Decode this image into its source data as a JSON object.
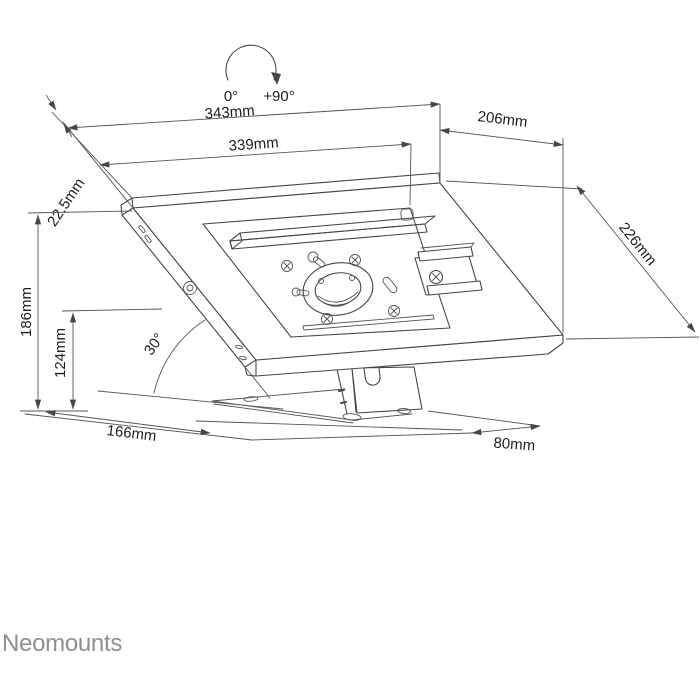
{
  "brand": "Neomounts",
  "colors": {
    "line": "#474747",
    "label": "#1e1e1e",
    "brand_gray": "#8f8f8f",
    "background": "#ffffff"
  },
  "rotation_indicator": {
    "start": "0°",
    "end": "+90°"
  },
  "dimensions": {
    "outer_width": "343mm",
    "inner_width": "339mm",
    "top_depth": "206mm",
    "side_depth": "226mm",
    "edge_thickness": "22.5mm",
    "total_height": "186mm",
    "pivot_height": "124mm",
    "base_depth": "166mm",
    "rear_offset": "80mm",
    "tilt_angle": "30°"
  }
}
